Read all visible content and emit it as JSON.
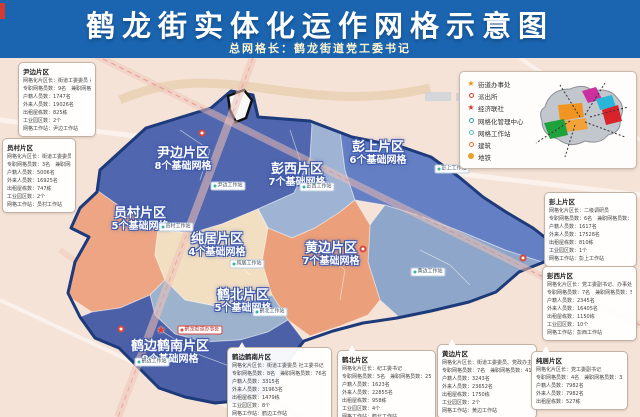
{
  "header": {
    "title": "鹤龙街实体化运作网格示意图",
    "subtitle": "总网格长：鹤龙街道党工委书记"
  },
  "colors": {
    "header_bg": "#1a64b0",
    "map_bg": "#f6e3d7",
    "district_outline": "#1d3a7a",
    "road_pink": "#eec3b8",
    "region_yinbian": "#5066ae",
    "region_pengxi": "#9fb3d4",
    "region_pengshang": "#647fc4",
    "region_right_grey": "#8ea6c9",
    "region_yuancun": "#eda584",
    "region_chunju": "#f2dfc2",
    "region_huangbian": "#eb9f7a",
    "region_hebei": "#9db3cd",
    "region_hebian": "#4c60a8",
    "star_red": "#e53c28",
    "legend_orange_star": "#f0920e",
    "legend_red": "#d5382c",
    "legend_teal": "#35b3a9",
    "legend_orange_ring": "#e8732b",
    "legend_gold": "#e8a22b"
  },
  "legend": {
    "items": [
      {
        "label": "街道办事处",
        "type": "star",
        "color": "#f0920e"
      },
      {
        "label": "派出所",
        "type": "ring",
        "color": "#d5382c"
      },
      {
        "label": "经济联社",
        "type": "star",
        "color": "#d5382c"
      },
      {
        "label": "网格化管理中心",
        "type": "ddot",
        "color": "#2aa79d"
      },
      {
        "label": "网格工作站",
        "type": "ddot",
        "color": "#55c2b8"
      },
      {
        "label": "建筑",
        "type": "ring",
        "color": "#e8732b"
      },
      {
        "label": "地铁",
        "type": "fdot",
        "color": "#e8a22b"
      }
    ]
  },
  "map": {
    "districts": [
      {
        "id": "yinbian",
        "name": "尹边片区",
        "grids": "8个基础网格",
        "x": 183,
        "y": 147
      },
      {
        "id": "pengxi",
        "name": "彭西片区",
        "grids": "7个基础网格",
        "x": 297,
        "y": 163
      },
      {
        "id": "pengshang",
        "name": "彭上片区",
        "grids": "6个基础网格",
        "x": 378,
        "y": 141
      },
      {
        "id": "yuancun",
        "name": "员村片区",
        "grids": "5个基础网格",
        "x": 140,
        "y": 207
      },
      {
        "id": "chunju",
        "name": "纯居片区",
        "grids": "4个基础网格",
        "x": 217,
        "y": 233
      },
      {
        "id": "huangbian",
        "name": "黄边片区",
        "grids": "7个基础网格",
        "x": 331,
        "y": 242
      },
      {
        "id": "hebei",
        "name": "鹤北片区",
        "grids": "5个基础网格",
        "x": 243,
        "y": 289
      },
      {
        "id": "hebian",
        "name": "鹤边鹤南片区",
        "grids": "8个基础网格",
        "x": 170,
        "y": 340
      }
    ],
    "stations": [
      {
        "label": "尹边工作站",
        "x": 228,
        "y": 186
      },
      {
        "label": "彭西工作站",
        "x": 317,
        "y": 187
      },
      {
        "label": "彭上工作站",
        "x": 452,
        "y": 169
      },
      {
        "label": "员村工作站",
        "x": 176,
        "y": 227
      },
      {
        "label": "纯居工作站",
        "x": 247,
        "y": 264
      },
      {
        "label": "黄边工作站",
        "x": 428,
        "y": 272
      },
      {
        "label": "鹤北工作站",
        "x": 270,
        "y": 312
      },
      {
        "label": "鹤边工作站",
        "x": 152,
        "y": 362
      }
    ],
    "hq_chip": {
      "label": "鹤龙街道办事处",
      "x": 200,
      "y": 330
    },
    "hq_star": {
      "x": 161,
      "y": 330
    },
    "metro_badges": [
      {
        "x": 202,
        "y": 133
      },
      {
        "x": 363,
        "y": 249
      },
      {
        "x": 523,
        "y": 258
      },
      {
        "x": 121,
        "y": 329
      }
    ]
  },
  "boxes": {
    "yinbian": {
      "title": "尹边片区",
      "rows": [
        "网格化片区长：街道工委委员 兼武装部长",
        "专职网格员数：9名　兼职网格员数：19名",
        "户籍人员数：1747名",
        "外来人员数：19026名",
        "出租屋栋数：825栋",
        "工业园区数：2个",
        "网格工作站：尹边工作站"
      ]
    },
    "yuancun": {
      "title": "员村片区",
      "rows": [
        "网格化片区长：街道工委委员 人大工委主任",
        "专职网格员数：3名　兼职网格员数：20名",
        "户籍人员数：5006名",
        "外来人员数：16925名",
        "出租屋栋数：747栋",
        "工业园区数：2个",
        "网格工作站：员村工作站"
      ]
    },
    "pengshang": {
      "title": "彭上片区",
      "rows": [
        "网格化片区长：二级调研员",
        "专职网格员数：6名　兼职网格员数：36名",
        "户籍人员数：1617名",
        "外来人员数：17528名",
        "出租屋栋数：810栋",
        "工业园区数：1个",
        "网格工作站：彭上工作站"
      ]
    },
    "pengxi": {
      "title": "彭西片区",
      "rows": [
        "网格化片区长：党工委副书记、办事处主任",
        "专职网格员数：7名　兼职网格员数：50名",
        "户籍人员数：2345名",
        "外来人员数：16405名",
        "出租屋栋数：1150栋",
        "工业园区数：10个",
        "网格工作站：彭西工作站"
      ]
    },
    "hebian": {
      "title": "鹤边鹤南片区",
      "rows": [
        "网格化片区长：街道工委委员 社工委书记",
        "专职网格员数：8名　兼职网格员数：76名",
        "户籍人员数：3315名",
        "外来人员数：31963名",
        "出租屋栋数：1479栋",
        "工业园区数：8个",
        "网格工作站：鹤边工作站"
      ]
    },
    "hebei": {
      "title": "鹤北片区",
      "rows": [
        "网格化片区长：纪工委书记",
        "专职网格员数：5名　兼职网格员数：25名",
        "户籍人员数：1623名",
        "外来人员数：22855名",
        "出租屋栋数：958栋",
        "工业园区数：4个",
        "网格工作站：鹤北工作站"
      ]
    },
    "huangbian": {
      "title": "黄边片区",
      "rows": [
        "网格化片区长：街道工委委员、党政办主任",
        "专职网格员数：7名　兼职网格员数：41名",
        "户籍人员数：3243名",
        "外来人员数：23652名",
        "出租屋栋数：1750栋",
        "工业园区数：2个",
        "网格工作站：黄边工作站"
      ]
    },
    "chunju": {
      "title": "纯居片区",
      "rows": [
        "网格化片区长：党工委副书记",
        "专职网格员数：4名　兼职网格员数：35名",
        "户籍人员数：7982名",
        "外来人员数：7982名",
        "出租屋栋数：527栋"
      ]
    }
  }
}
